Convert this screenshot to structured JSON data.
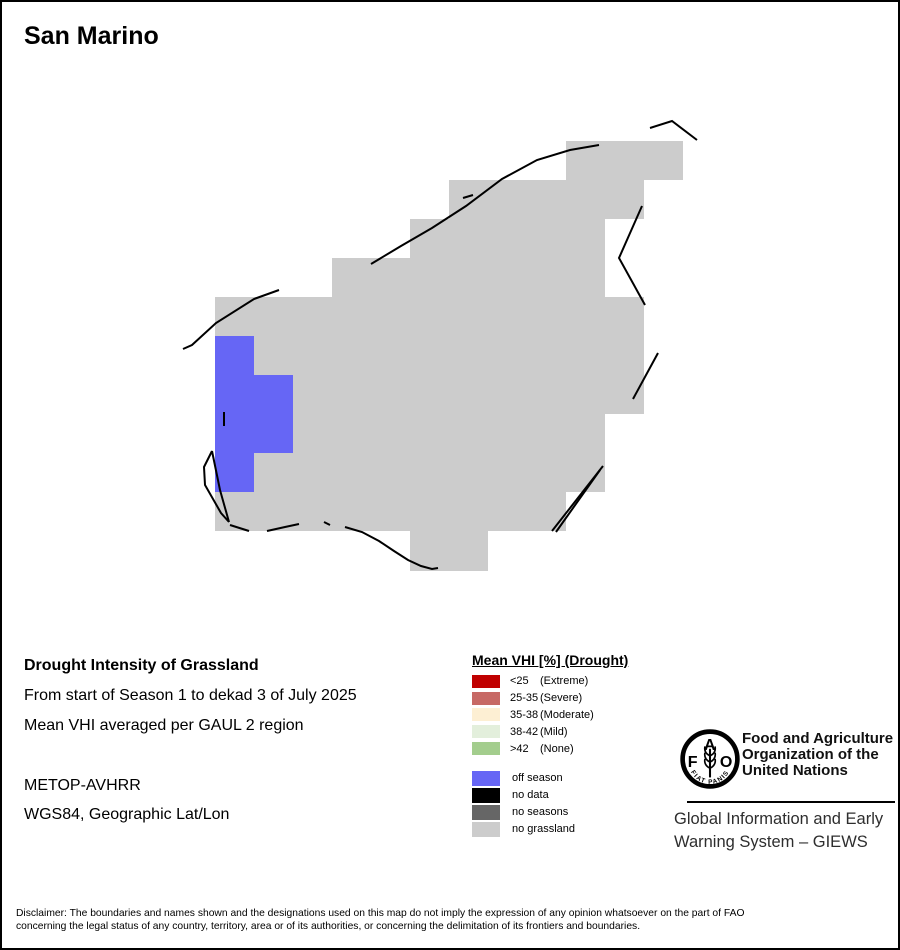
{
  "title": "San Marino",
  "info": {
    "product_title": "Drought Intensity of Grassland",
    "period": "From start of Season 1 to dekad 3 of July 2025",
    "aggregation": "Mean VHI averaged per GAUL 2 region",
    "sensor": "METOP-AVHRR",
    "projection": "WGS84, Geographic Lat/Lon"
  },
  "legend": {
    "title": "Mean VHI [%] (Drought)",
    "drought_classes": [
      {
        "range": "<25",
        "label": "(Extreme)",
        "color": "#C00000"
      },
      {
        "range": "25-35",
        "label": "(Severe)",
        "color": "#C76965"
      },
      {
        "range": "35-38",
        "label": "(Moderate)",
        "color": "#FDEFD3"
      },
      {
        "range": "38-42",
        "label": "(Mild)",
        "color": "#E3EFDC"
      },
      {
        "range": ">42",
        "label": "(None)",
        "color": "#A3CD8D"
      }
    ],
    "season_classes": [
      {
        "label": "off season",
        "color": "#6666F5"
      },
      {
        "label": "no data",
        "color": "#000000"
      },
      {
        "label": "no seasons",
        "color": "#666666"
      },
      {
        "label": "no grassland",
        "color": "#CCCCCC"
      }
    ]
  },
  "map": {
    "colors": {
      "no_grassland": "#CCCCCC",
      "off_season": "#6666F5",
      "boundary": "#000000"
    },
    "gray_rects": [
      [
        564,
        139,
        117,
        39
      ],
      [
        447,
        178,
        195,
        39
      ],
      [
        408,
        217,
        195,
        39
      ],
      [
        330,
        256,
        273,
        39
      ],
      [
        213,
        295,
        429,
        39
      ],
      [
        252,
        334,
        390,
        39
      ],
      [
        291,
        373,
        351,
        39
      ],
      [
        291,
        412,
        312,
        39
      ],
      [
        252,
        451,
        351,
        39
      ],
      [
        213,
        490,
        351,
        39
      ],
      [
        408,
        529,
        78,
        40
      ]
    ],
    "blue_rects": [
      [
        213,
        334,
        39,
        156
      ],
      [
        252,
        373,
        39,
        78
      ]
    ],
    "boundary_lines": [
      [
        648,
        126,
        670,
        119,
        695,
        138
      ],
      [
        369,
        262,
        399,
        244,
        430,
        226,
        464,
        204,
        500,
        177,
        535,
        158,
        568,
        148,
        597,
        143
      ],
      [
        461,
        196,
        471,
        193
      ],
      [
        640,
        204,
        617,
        256,
        643,
        303
      ],
      [
        656,
        351,
        631,
        397
      ],
      [
        181,
        347,
        190,
        343,
        214,
        321,
        252,
        297,
        277,
        288
      ],
      [
        222,
        410,
        222,
        424
      ],
      [
        210,
        449,
        202,
        465,
        203,
        483,
        219,
        511,
        227,
        520
      ],
      [
        210,
        449,
        218,
        488,
        227,
        520
      ],
      [
        228,
        523,
        247,
        529
      ],
      [
        265,
        529,
        283,
        525,
        297,
        522
      ],
      [
        322,
        520,
        328,
        523
      ],
      [
        343,
        525,
        360,
        530,
        377,
        539,
        392,
        549,
        406,
        558,
        419,
        564,
        430,
        567,
        436,
        566
      ],
      [
        550,
        529,
        601,
        464
      ],
      [
        554,
        530,
        598,
        468
      ]
    ]
  },
  "fao": {
    "logo_letters": {
      "f": "F",
      "a": "A",
      "o": "O"
    },
    "motto": "FIAT   PANIS",
    "org_lines": [
      "Food and Agriculture",
      "Organization of the",
      "United Nations"
    ],
    "giews_lines": [
      "Global Information and Early",
      "Warning System – GIEWS"
    ]
  },
  "disclaimer": {
    "line1": "Disclaimer: The boundaries and names shown and the designations used on this map do not imply the expression of any opinion whatsoever on the part of FAO",
    "line2": "concerning the legal status of any country, territory, area or of its authorities, or concerning the delimitation of its frontiers and boundaries."
  }
}
